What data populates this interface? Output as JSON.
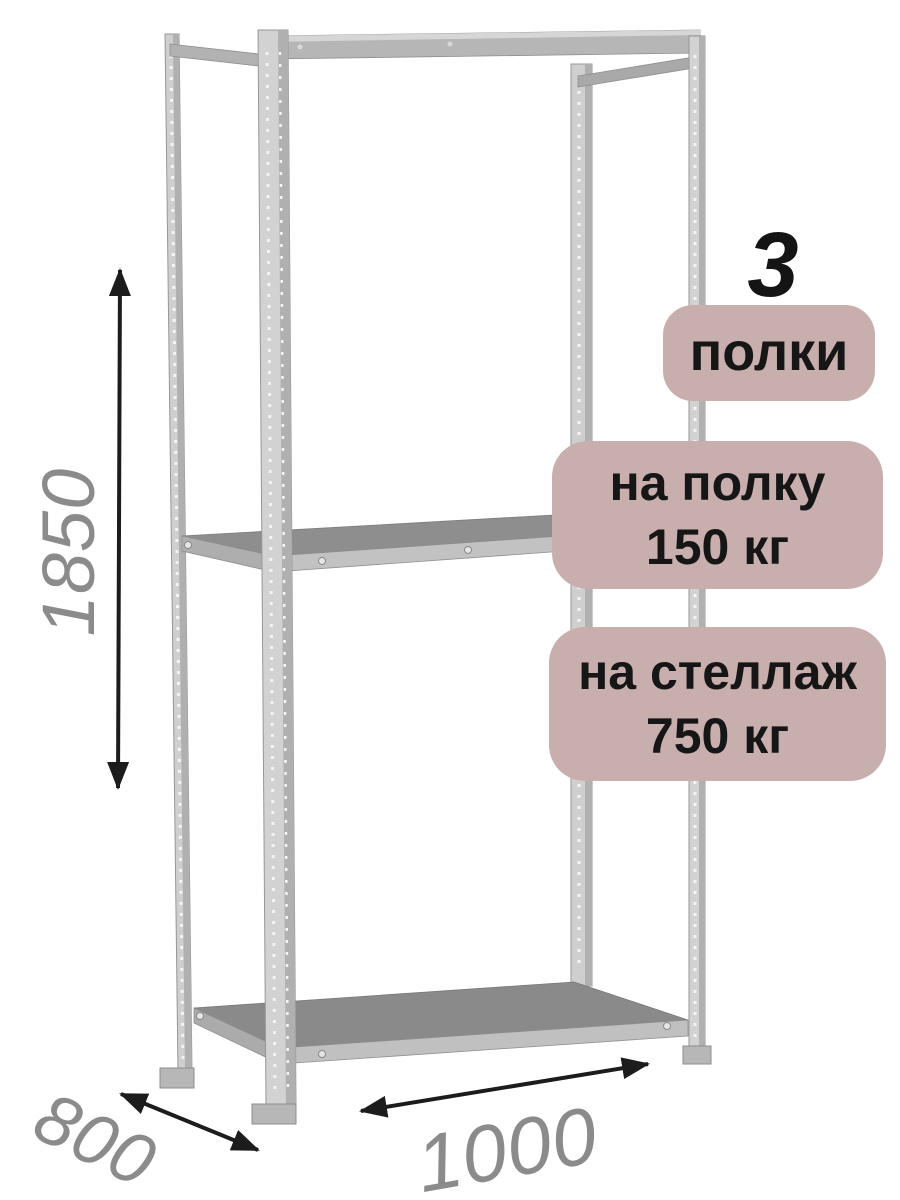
{
  "badges": {
    "shelf_count": "3",
    "shelf_count_label": "полки",
    "per_shelf": {
      "line1": "на полку",
      "line2": "150 кг"
    },
    "per_rack": {
      "line1": "на стеллаж",
      "line2": "750 кг"
    }
  },
  "dimensions": {
    "height_mm": "1850",
    "depth_mm": "800",
    "width_mm": "1000"
  },
  "colors": {
    "badge_background": "#c8aeac",
    "badge_text": "#161616",
    "big_number_text": "#141414",
    "dimension_text": "#8b8b8b",
    "arrow": "#1c1c1c",
    "frame_light": "#d2d2d2",
    "frame_shade": "#b0b0b0",
    "shelf_surface": "#8b8b8b",
    "shelf_edge": "#c0c0c0",
    "background": "#ffffff"
  }
}
